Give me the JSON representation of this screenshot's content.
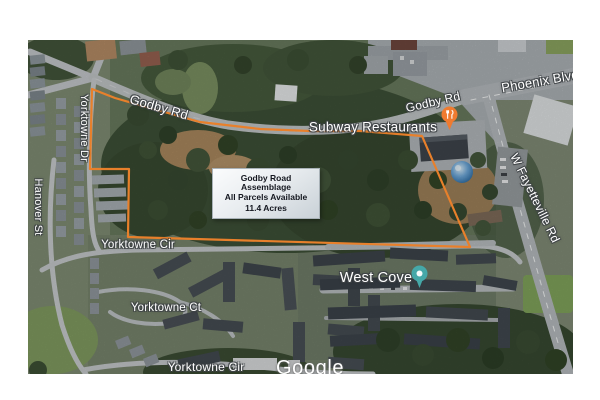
{
  "figure": {
    "attribution": "Google",
    "info_box": {
      "title": "Godby Road Assemblage",
      "line2": "All Parcels Available",
      "line3": "11.4 Acres"
    },
    "road_labels": {
      "godby_rd_west": "Godby Rd",
      "godby_rd_east": "Godby Rd",
      "phoenix_blvd": "Phoenix Blvd",
      "w_fayetteville_rd": "W Fayetteville Rd",
      "yorktowne_dr": "Yorktowne Dr",
      "hanover_st": "Hanover St",
      "yorktowne_cir_north": "Yorktowne Cir",
      "yorktowne_ct": "Yorktowne Ct",
      "yorktowne_cir_south": "Yorktowne Cir"
    },
    "poi_labels": {
      "subway": "Subway Restaurants",
      "west_cove": "West Cove"
    },
    "icons": {
      "subway_pin": "restaurant-fork-knife-map-pin",
      "west_cove_pin": "teal-poi-map-pin",
      "water_tower": "blue-water-tower"
    },
    "colors": {
      "parcel_boundary": "#E8802B",
      "restaurant_pin": "#EF7B30",
      "west_cove_pin": "#45A8A8"
    }
  }
}
